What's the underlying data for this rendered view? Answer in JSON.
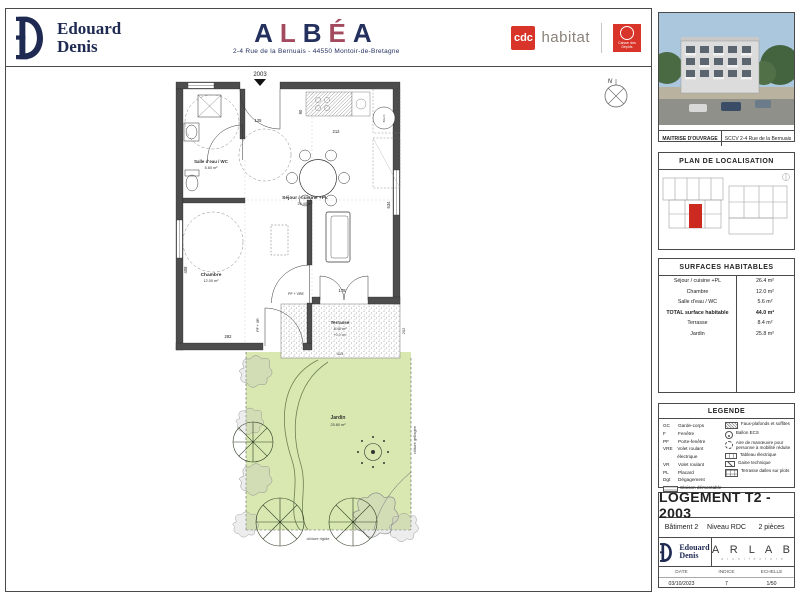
{
  "header": {
    "edouard_denis": {
      "name_line1": "Edouard",
      "name_line2": "Denis"
    },
    "albea": {
      "letters": [
        "A",
        "L",
        "B",
        "É",
        "A"
      ],
      "address": "2-4 Rue de la Bernuais - 44550 Montoir-de-Bretagne"
    },
    "cdc_habitat": {
      "square_text": "cdc",
      "suffix": "habitat"
    },
    "caisse_depots": {
      "text": "Caisse des Dépôts"
    }
  },
  "plan": {
    "unit_number": "2003",
    "compass": "N",
    "rooms": {
      "salle_eau": {
        "name": "Salle d'eau / WC",
        "area": "5.60 m²"
      },
      "chambre": {
        "name": "Chambre",
        "area": "12.00 m²"
      },
      "sejour": {
        "name": "Séjour / cuisine +PL",
        "area": "26.40 m²"
      },
      "terrasse": {
        "name": "Terrasse",
        "area": "8.40 m²",
        "note": "+0.0 cm"
      },
      "jardin": {
        "name": "Jardin",
        "area": "25.80 m²"
      }
    },
    "bec_label": "B.E.C.",
    "dims": {
      "d125": "125",
      "d90": "90",
      "d212": "212",
      "d634": "634",
      "d408": "408",
      "d282": "282",
      "d178": "178",
      "d413": "413",
      "d202": "202"
    },
    "labels": {
      "pf_vre": "PF + VRE",
      "pf_vr": "PF + VR",
      "cloture_rigide": "clôture rigide",
      "cloture_grillagee": "clôture grillagée"
    }
  },
  "sidebar": {
    "photo_caption": {
      "label": "MAITRISE D'OUVRAGE",
      "value": "SCCV 2-4 Rue de la Bernuais"
    },
    "localisation_title": "PLAN DE LOCALISATION",
    "surfaces": {
      "title": "SURFACES HABITABLES",
      "rows": [
        {
          "label": "Séjour / cuisine +PL",
          "value": "26.4 m²"
        },
        {
          "label": "Chambre",
          "value": "12.0 m²"
        },
        {
          "label": "Salle d'eau / WC",
          "value": "5.6 m²"
        },
        {
          "label": "TOTAL surface habitable",
          "value": "44.0 m²"
        },
        {
          "label": "Terrasse",
          "value": "8.4 m²"
        },
        {
          "label": "Jardin",
          "value": "25.8 m²"
        }
      ]
    },
    "legende": {
      "title": "LEGENDE",
      "abbreviations": [
        {
          "abbr": "GC",
          "label": "Garde-corps"
        },
        {
          "abbr": "F",
          "label": "Fenêtre"
        },
        {
          "abbr": "PF",
          "label": "Porte-fenêtre"
        },
        {
          "abbr": "VRE",
          "label": "Volet roulant électrique"
        },
        {
          "abbr": "VR",
          "label": "Volet roulant"
        },
        {
          "abbr": "PL",
          "label": "Placard"
        },
        {
          "abbr": "Dgt",
          "label": "Dégagement"
        },
        {
          "abbr": "",
          "label": "Cloison démontable"
        }
      ],
      "symbols": [
        {
          "icon": "hatch-icon",
          "label": "Faux-plafonds et soffites"
        },
        {
          "icon": "ballon-ecs-icon",
          "label": "Ballon ECS"
        },
        {
          "icon": "turning-circle-icon",
          "label": "Aire de manœuvre pour personne à mobilité réduite"
        },
        {
          "icon": "electric-panel-icon",
          "label": "Tableau électrique"
        },
        {
          "icon": "duct-icon",
          "label": "Gaine technique"
        },
        {
          "icon": "grid-icon",
          "label": "Terrasse dalles sur plots"
        }
      ]
    },
    "titleblock": {
      "title": "LOGEMENT T2 - 2003",
      "building": "Bâtiment 2",
      "level": "Niveau RDC",
      "pieces": "2 pièces",
      "logo": {
        "line1": "Edouard",
        "line2": "Denis"
      },
      "architect": {
        "name": "A R L A B",
        "subtitle": "a r c h i t e c t u r e"
      },
      "meta": {
        "date_label": "DATE",
        "date_value": "03/10/2023",
        "indice_label": "INDICE",
        "indice_value": "7",
        "echelle_label": "ECHELLE",
        "echelle_value": "1/50"
      }
    }
  },
  "colors": {
    "navy": "#1e2a52",
    "maroon": "#a34a5e",
    "red": "#d8342a",
    "wall_gray": "#4d4d4d",
    "garden_green": "#d8e8b0"
  }
}
